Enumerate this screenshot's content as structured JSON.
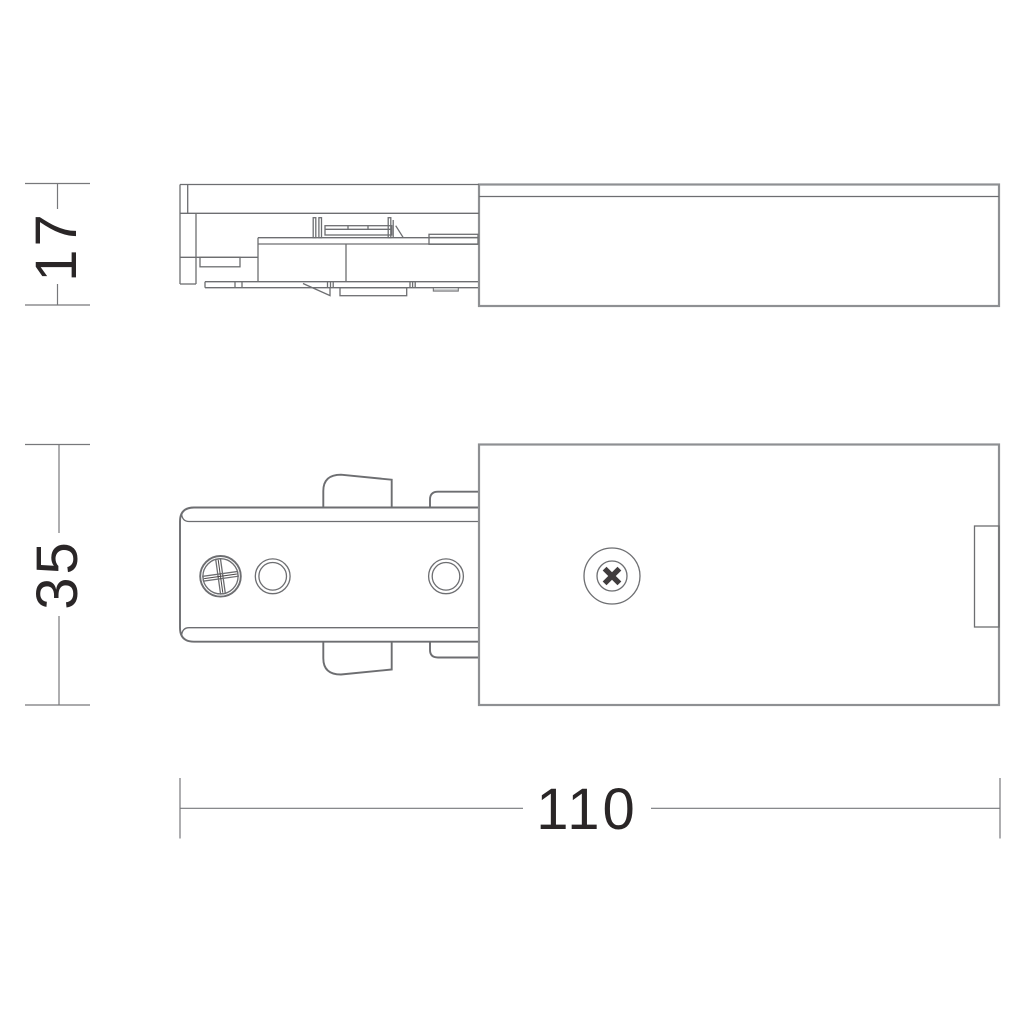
{
  "drawing": {
    "type": "technical-dimension-drawing",
    "subject": "track-lighting-live-end-power-feed-connector",
    "background": "#ffffff",
    "line_color": "#6d6e71",
    "outline_color": "#8e9093",
    "text_color": "#2a2627",
    "views": [
      {
        "id": "side-view",
        "description": "side elevation of adapter with cover"
      },
      {
        "id": "front-view",
        "description": "front elevation with screws and mounting holes"
      }
    ],
    "dimensions": {
      "side_height": {
        "value": "17",
        "orientation": "vertical"
      },
      "front_height": {
        "value": "35",
        "orientation": "vertical"
      },
      "overall_length": {
        "value": "110",
        "orientation": "horizontal"
      }
    }
  }
}
